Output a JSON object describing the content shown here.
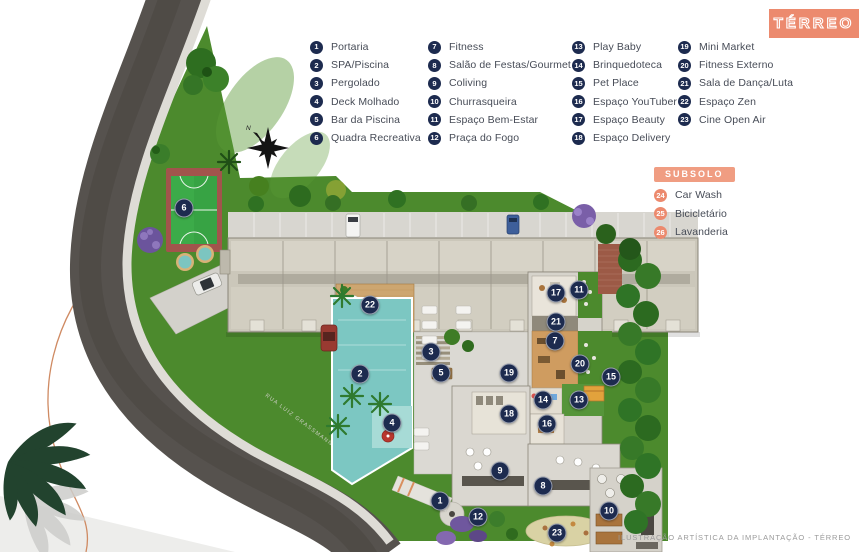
{
  "page": {
    "width": 859,
    "height": 552
  },
  "title_badge": {
    "label": "TÉRREO"
  },
  "caption": "ILUSTRAÇÃO ARTÍSTICA DA IMPLANTAÇÃO - TÉRREO",
  "compass": {
    "label": "N"
  },
  "street": {
    "label": "RUA LUIZ GRASSMANN"
  },
  "legend": {
    "columns": [
      {
        "items": [
          {
            "n": "1",
            "label": "Portaria"
          },
          {
            "n": "2",
            "label": "SPA/Piscina"
          },
          {
            "n": "3",
            "label": "Pergolado"
          },
          {
            "n": "4",
            "label": "Deck Molhado"
          },
          {
            "n": "5",
            "label": "Bar da Piscina"
          },
          {
            "n": "6",
            "label": "Quadra Recreativa"
          }
        ]
      },
      {
        "items": [
          {
            "n": "7",
            "label": "Fitness"
          },
          {
            "n": "8",
            "label": "Salão de Festas/Gourmet"
          },
          {
            "n": "9",
            "label": "Coliving"
          },
          {
            "n": "10",
            "label": "Churrasqueira"
          },
          {
            "n": "11",
            "label": "Espaço Bem-Estar"
          },
          {
            "n": "12",
            "label": "Praça do Fogo"
          }
        ]
      },
      {
        "items": [
          {
            "n": "13",
            "label": "Play Baby"
          },
          {
            "n": "14",
            "label": "Brinquedoteca"
          },
          {
            "n": "15",
            "label": "Pet Place"
          },
          {
            "n": "16",
            "label": "Espaço YouTuber"
          },
          {
            "n": "17",
            "label": "Espaço Beauty"
          },
          {
            "n": "18",
            "label": "Espaço Delivery"
          }
        ]
      },
      {
        "items": [
          {
            "n": "19",
            "label": "Mini Market"
          },
          {
            "n": "20",
            "label": "Fitness Externo"
          },
          {
            "n": "21",
            "label": "Sala de Dança/Luta"
          },
          {
            "n": "22",
            "label": "Espaço Zen"
          },
          {
            "n": "23",
            "label": "Cine Open Air"
          }
        ]
      }
    ]
  },
  "subsolo": {
    "title": "SUBSOLO",
    "items": [
      {
        "n": "24",
        "label": "Car Wash"
      },
      {
        "n": "25",
        "label": "Bicicletário"
      },
      {
        "n": "26",
        "label": "Lavanderia"
      }
    ]
  },
  "plan": {
    "markers": [
      {
        "n": "1",
        "x": 440,
        "y": 501
      },
      {
        "n": "2",
        "x": 360,
        "y": 374
      },
      {
        "n": "3",
        "x": 431,
        "y": 352
      },
      {
        "n": "4",
        "x": 392,
        "y": 423
      },
      {
        "n": "5",
        "x": 441,
        "y": 373
      },
      {
        "n": "6",
        "x": 184,
        "y": 208
      },
      {
        "n": "7",
        "x": 555,
        "y": 341
      },
      {
        "n": "8",
        "x": 543,
        "y": 486
      },
      {
        "n": "9",
        "x": 500,
        "y": 471
      },
      {
        "n": "10",
        "x": 609,
        "y": 511
      },
      {
        "n": "11",
        "x": 579,
        "y": 290
      },
      {
        "n": "12",
        "x": 478,
        "y": 517
      },
      {
        "n": "13",
        "x": 579,
        "y": 400
      },
      {
        "n": "14",
        "x": 543,
        "y": 400
      },
      {
        "n": "15",
        "x": 611,
        "y": 377
      },
      {
        "n": "16",
        "x": 547,
        "y": 424
      },
      {
        "n": "17",
        "x": 556,
        "y": 293
      },
      {
        "n": "18",
        "x": 509,
        "y": 414
      },
      {
        "n": "19",
        "x": 509,
        "y": 373
      },
      {
        "n": "20",
        "x": 580,
        "y": 364
      },
      {
        "n": "21",
        "x": 556,
        "y": 322
      },
      {
        "n": "22",
        "x": 370,
        "y": 305
      },
      {
        "n": "23",
        "x": 557,
        "y": 533
      }
    ]
  },
  "colors": {
    "accent_salmon": "#EC8A6E",
    "marker_navy": "#1D2B4F",
    "legend_text": "#474C57",
    "lawn_green": "#4C8A2D",
    "pool_teal": "#7CC7C2",
    "road_gray": "#56524E"
  }
}
